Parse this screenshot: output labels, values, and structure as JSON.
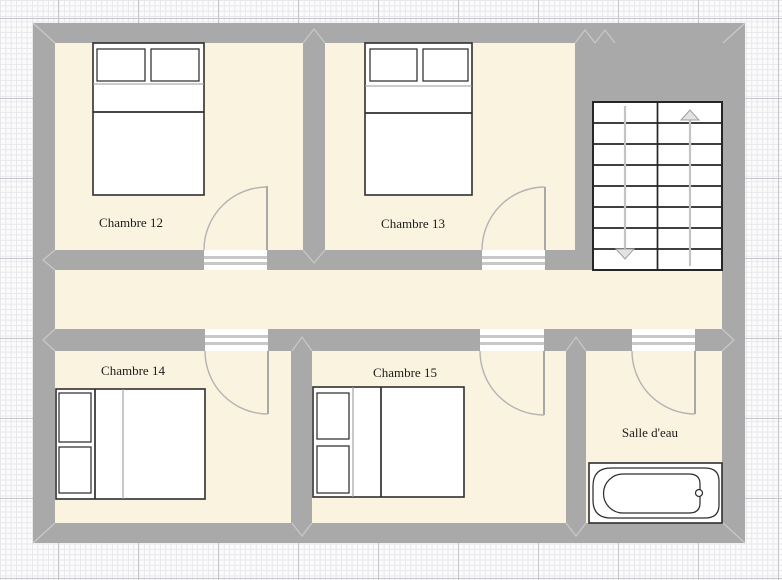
{
  "palette": {
    "background": "#fbfbfc",
    "grid_minor": "#e7e7ec",
    "grid_major": "#c5c5cc",
    "wall": "#a9a9a9",
    "wall_seam": "#c9c9c9",
    "room_fill": "#faf3e0",
    "furniture_stroke": "#2f2f2f",
    "door_fill": "#ffffff",
    "door_stripe": "#c8c8c8",
    "door_swing": "#b3b3b3",
    "stairs_guide": "#c4c4c4",
    "label_color": "#1b1b1b"
  },
  "floor_plan": {
    "rooms": [
      {
        "id": "chambre-12",
        "label": "Chambre 12"
      },
      {
        "id": "chambre-13",
        "label": "Chambre 13"
      },
      {
        "id": "chambre-14",
        "label": "Chambre 14"
      },
      {
        "id": "chambre-15",
        "label": "Chambre 15"
      },
      {
        "id": "salle-deau",
        "label": "Salle d'eau"
      }
    ],
    "corridor": {
      "id": "corridor"
    },
    "stairs": {
      "flights": 2,
      "steps_per_flight": 8,
      "arrows": [
        "down",
        "up"
      ]
    },
    "furniture": {
      "double_beds": 4,
      "bathtubs": 1,
      "doors": 5
    }
  }
}
